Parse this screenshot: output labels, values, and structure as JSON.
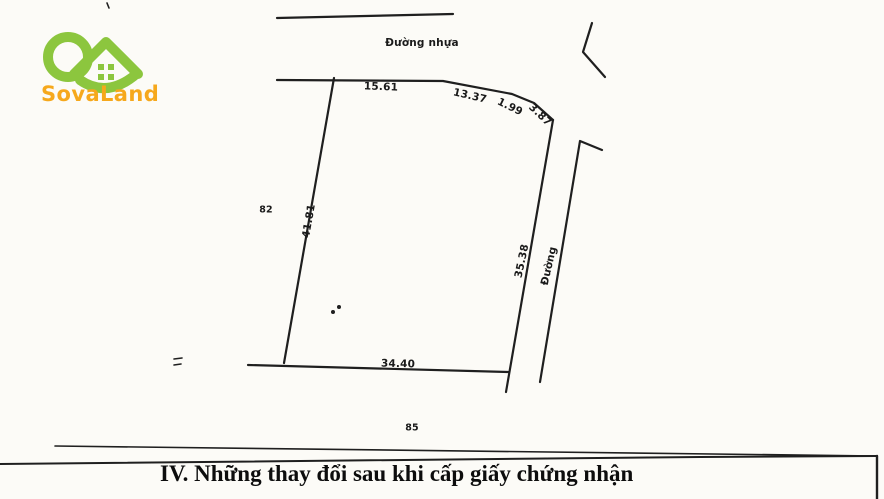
{
  "brand": {
    "name": "SovaLand"
  },
  "colors": {
    "logo_green": "#8cc63e",
    "logo_orange": "#f6a81c",
    "line": "#1f1f1f",
    "paper": "#fcfbf7"
  },
  "map": {
    "top_road_label": "Đường nhựa",
    "right_road_label": "Đường",
    "adjacent_parcel_left": "82",
    "adjacent_parcel_bottom": "85",
    "edges": {
      "top_1": "15.61",
      "top_2": "13.37",
      "top_3": "1.99",
      "top_4": "3.87",
      "left": "41.81",
      "right": "35.38",
      "bottom": "34.40"
    }
  },
  "section": {
    "title": "IV. Những thay đổi sau khi cấp giấy chứng nhận"
  }
}
